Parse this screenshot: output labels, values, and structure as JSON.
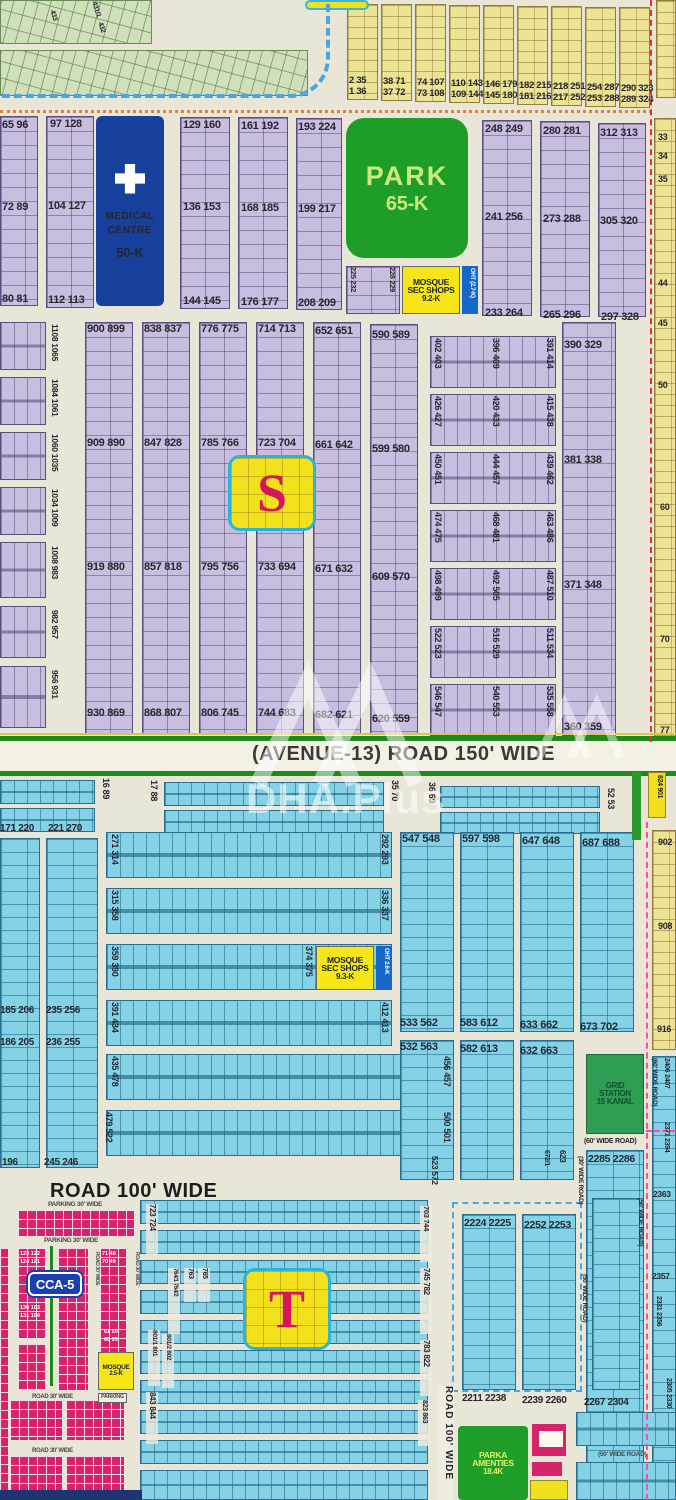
{
  "colors": {
    "purple_plots": "#c9bedf",
    "cyan_plots": "#85d2e6",
    "yellow_plots": "#ece394",
    "pink_commercial": "#d6246c",
    "park_green": "#1e9e28",
    "medical_blue": "#16409b",
    "mosque_yellow": "#f6e617",
    "grid_station_green": "#2f9e55",
    "marker_fill": "#f2e11c",
    "marker_letter": "#d4175c",
    "road_green": "#1d8a1d"
  },
  "watermark": {
    "text": "DHA.Plus"
  },
  "topLeft": {
    "labels": [
      "433",
      "432",
      "431/1"
    ]
  },
  "topYellow": {
    "pairs": [
      [
        "2 35",
        "1 36"
      ],
      [
        "38 71",
        "37 72"
      ],
      [
        "74 107",
        "73 108"
      ],
      [
        "110 143",
        "109 144"
      ],
      [
        "146 179",
        "145 180"
      ],
      [
        "182 215",
        "181 216"
      ],
      [
        "218 251",
        "217 252"
      ],
      [
        "254 287",
        "253 288"
      ],
      [
        "290 323",
        "289 324"
      ]
    ]
  },
  "band2": {
    "colA": [
      "65 96",
      "72 89",
      "80 81"
    ],
    "colB": [
      "97 128",
      "104 127",
      "112 113"
    ],
    "colC": [
      "129 160",
      "136 153",
      "144 145"
    ],
    "colD": [
      "161 192",
      "168 185",
      "176 177"
    ],
    "colE": [
      "193 224",
      "199 217",
      "208 209"
    ],
    "colF": [
      "248 249",
      "241 256",
      "233 264"
    ],
    "colG": [
      "280 281",
      "273 288",
      "265 296"
    ],
    "colH": [
      "312 313",
      "305 320",
      "297 328"
    ],
    "medical": [
      "MEDICAL",
      "CENTRE",
      "50-K"
    ],
    "park": [
      "PARK",
      "65-K"
    ],
    "mosque": [
      "MOSQUE",
      "SEC SHOPS",
      "9.2-K"
    ],
    "oht": "OHT (2.7-K)",
    "mini": [
      "225 232",
      "228 229"
    ]
  },
  "sectorS": {
    "marker": "S",
    "leftRows": [
      "1108 1065",
      "1084 1061",
      "1060 1035",
      "1034 1009",
      "1008 983",
      "982 957",
      "956 931"
    ],
    "c1": [
      "900 899",
      "909 890",
      "919 880",
      "930 869"
    ],
    "c2": [
      "838 837",
      "847 828",
      "857 818",
      "868 807"
    ],
    "c3": [
      "776 775",
      "785 766",
      "795 756",
      "806 745"
    ],
    "c4": [
      "714 713",
      "723 704",
      "733 694",
      "744 683"
    ],
    "c5": [
      "652 651",
      "661 642",
      "671 632",
      "682 621"
    ],
    "c6": [
      "590 589",
      "599 580",
      "609 570",
      "620 559"
    ],
    "strips": [
      [
        "402 403",
        "396 409",
        "391 414"
      ],
      [
        "426 427",
        "420 433",
        "415 438"
      ],
      [
        "450 451",
        "444 457",
        "439 462"
      ],
      [
        "474 475",
        "468 481",
        "463 486"
      ],
      [
        "498 499",
        "492 505",
        "487 510"
      ],
      [
        "522 523",
        "516 529",
        "511 534"
      ],
      [
        "546 547",
        "540 553",
        "535 558"
      ]
    ],
    "c7": [
      "390 329",
      "381 338",
      "371 348",
      "360 359"
    ]
  },
  "avenue": {
    "label": "(AVENUE-13) ROAD 150' WIDE"
  },
  "rightEdge": {
    "upper": [
      "33",
      "34",
      "35",
      "44",
      "45",
      "50",
      "60",
      "70",
      "77"
    ],
    "box": "824 901",
    "lower": [
      "902",
      "908",
      "916"
    ]
  },
  "sectorT": {
    "marker": "T",
    "topStrips": [
      "16 89",
      "17 88",
      "35 70",
      "36 69",
      "52 53"
    ],
    "col1": [
      "171 220",
      "185 206",
      "186 205",
      "196"
    ],
    "col2": [
      "221 270",
      "235 256",
      "236 255",
      "245 246"
    ],
    "strips": [
      [
        "271 314",
        "292 293"
      ],
      [
        "315 358",
        "336 337"
      ],
      [
        "359 390",
        "374 375"
      ],
      [
        "391 434",
        "412 413"
      ],
      [
        "435 478",
        "456 457"
      ],
      [
        "479 522",
        "500 501"
      ]
    ],
    "mosque": [
      "MOSQUE",
      "SEC SHOPS",
      "9.3-K"
    ],
    "oht": "OHT 2.6-K",
    "cols": [
      [
        "547 548",
        "533 562"
      ],
      [
        "597 598",
        "583 612"
      ],
      [
        "647 648",
        "633 662"
      ],
      [
        "687 688",
        "673 702"
      ]
    ],
    "cols2": [
      "532 563",
      "582 613",
      "632 663"
    ],
    "colsBottom": "523 572"
  },
  "road100": {
    "label": "ROAD 100' WIDE"
  },
  "gridStation": {
    "lines": [
      "GRID",
      "STATION",
      "15 KANAL"
    ],
    "road60v": "(60' WIDE ROAD)",
    "road60h": "(60' WIDE ROAD)",
    "road30v": "(30' WIDE ROAD)",
    "road50v": "(50' WIDE ROAD)",
    "col": "2285 2286",
    "leftLabels": [
      "672/1",
      "623"
    ],
    "rightLabels": [
      "2406 2407",
      "2371 2394",
      "2363",
      "2357",
      "2331 2356",
      "2305 2330"
    ]
  },
  "cca": {
    "badge": "CCA-5",
    "parkingTop": "PARKING 30' WIDE",
    "parkingBottom": "PARKING 30' WIDE",
    "roadH": [
      "ROAD 30' WIDE",
      "ROAD 30' WIDE"
    ],
    "roadV": [
      "ROAD 30' WIDE",
      "ROAD 30' WIDE"
    ],
    "mosque": [
      "MOSQUE",
      "2.5-K"
    ],
    "parkingSmall": "PARKING",
    "pairs": [
      "123 122",
      "124 121",
      "71 48",
      "70 49",
      "130 103",
      "131 104",
      "61 50",
      "60 59"
    ]
  },
  "bottom": {
    "leftRot": [
      "723 724",
      "764/1 764/2",
      "763",
      "765",
      "801/1 801",
      "801/2 802",
      "843 844"
    ],
    "rightRot": [
      "703 744",
      "745 782",
      "783 822",
      "823 863"
    ],
    "road100v": "ROAD 100' WIDE",
    "colTops": [
      "2224 2225",
      "2252 2253"
    ],
    "colBottoms": [
      "2211 2238",
      "2239 2260",
      "2267 2304"
    ],
    "road50v": "(50' WIDE ROAD)",
    "road50h": "(50' WIDE ROAD)",
    "parka": [
      "PARKA",
      "AMENTIES",
      "18.4K"
    ]
  }
}
